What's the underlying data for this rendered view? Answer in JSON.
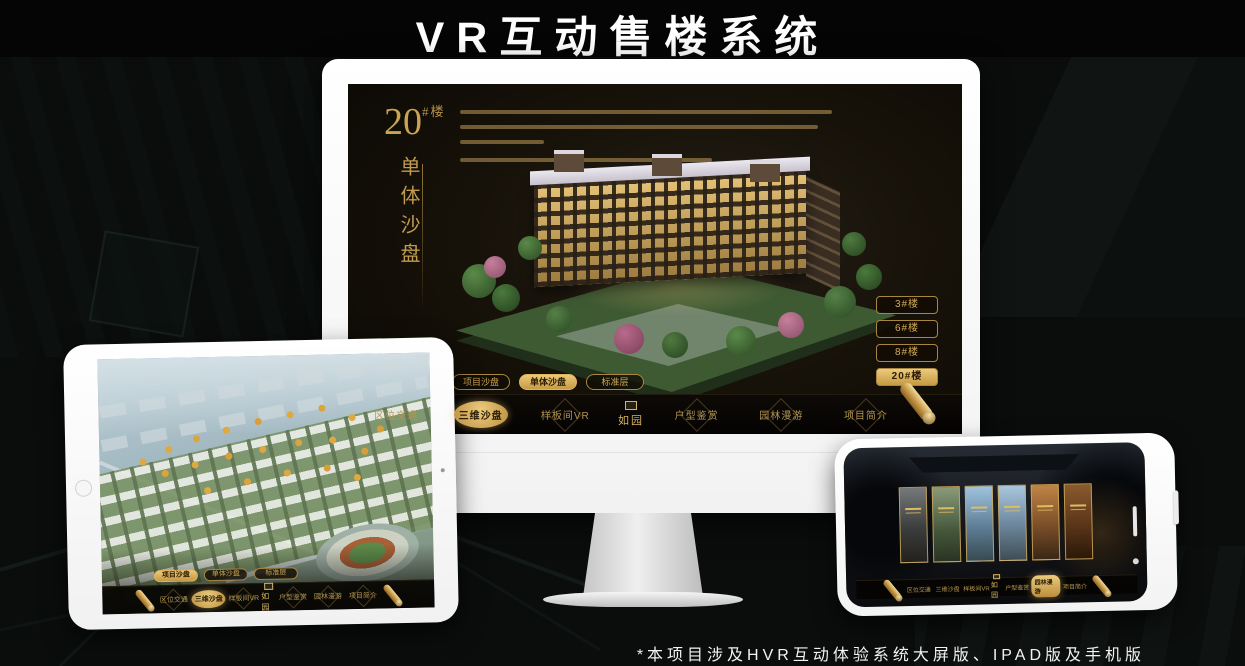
{
  "page": {
    "title": "VR互动售楼系统",
    "footnote": "*本项目涉及HVR互动体验系统大屏版、IPAD版及手机版"
  },
  "colors": {
    "accent_gold": "#c9a14d",
    "accent_gold_bright": "#ecc878",
    "screen_dark": "#17120a",
    "device_white": "#fdfdfd",
    "title_text": "#ffffff"
  },
  "app_nav": {
    "logo": "如园",
    "items": [
      "区位交通",
      "三维沙盘",
      "样板间VR",
      "户型鉴赏",
      "园林漫游",
      "项目简介"
    ]
  },
  "monitor_app": {
    "headline": {
      "number": "20",
      "suffix": "#楼",
      "vertical_caption": "单体沙盘"
    },
    "floor_buttons": [
      {
        "label": "3#楼",
        "active": false
      },
      {
        "label": "6#楼",
        "active": false
      },
      {
        "label": "8#楼",
        "active": false
      },
      {
        "label": "20#楼",
        "active": true
      }
    ],
    "sub_tabs": [
      {
        "label": "项目沙盘",
        "active": false
      },
      {
        "label": "单体沙盘",
        "active": true
      },
      {
        "label": "标准层",
        "active": false
      }
    ],
    "active_nav": "三维沙盘"
  },
  "ipad_app": {
    "sub_tabs": [
      {
        "label": "项目沙盘",
        "active": true
      },
      {
        "label": "单体沙盘",
        "active": false
      },
      {
        "label": "标准层",
        "active": false
      }
    ],
    "active_nav": "三维沙盘"
  },
  "phone_app": {
    "active_nav": "园林漫游",
    "cards": [
      {
        "style": "background:linear-gradient(180deg,#76797a,#3a3d3c 55%,#23211d)"
      },
      {
        "style": "background:linear-gradient(180deg,#8a9a7a,#44563a 60%,#2a3322)"
      },
      {
        "style": "background:linear-gradient(180deg,#9fc3de,#5d7d96 55%,#374a52)"
      },
      {
        "style": "background:linear-gradient(180deg,#aac6dd,#6f8aa0 50%,#3f4e55)"
      },
      {
        "style": "background:linear-gradient(180deg,#c08446,#7a4e28 55%,#3a2715)"
      },
      {
        "style": "background:linear-gradient(180deg,#8a5a2e,#5a3518 55%,#2a1808)"
      }
    ]
  }
}
